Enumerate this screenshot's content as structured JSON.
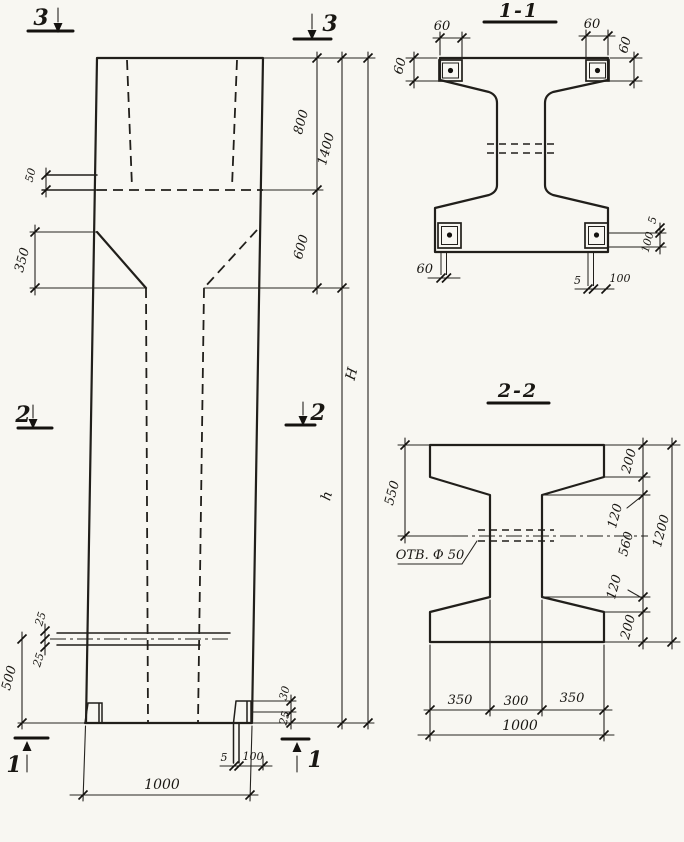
{
  "page": {
    "paper_color": "#f8f7f2",
    "ink_color": "#211f1b",
    "drawing_type": "reinforced concrete column working drawing"
  },
  "elevation": {
    "markers": {
      "top_left": "3",
      "top_right": "3",
      "mid_left": "2",
      "mid_right": "2",
      "bottom_left": "1",
      "bottom_right": "1"
    },
    "dims": {
      "ledge_height": "50",
      "taper_height": "350",
      "cap_upper": "800",
      "cap_total": "1400",
      "cap_lower": "600",
      "total_height": "H",
      "shaft_height": "h",
      "hole_above_center": "25",
      "hole_below_center": "25",
      "hole_to_base": "500",
      "foot_upper": "30",
      "foot_lower": "25",
      "plate_thickness": "5",
      "plate_length": "100",
      "base_width": "1000"
    }
  },
  "section11": {
    "title": "1-1",
    "dims": {
      "plate_tl_width": "60",
      "plate_tl_height": "60",
      "plate_tr_width": "60",
      "plate_tr_height": "60",
      "plate_bl_width": "60",
      "plate_br_thickness": "5",
      "plate_br_length": "100",
      "plate_right_thickness": "5",
      "plate_right_length": "100"
    }
  },
  "section22": {
    "title": "2-2",
    "hole_note": "ОТВ. Ф 50",
    "dims": {
      "top_to_hole": "550",
      "flange_top": "200",
      "haunch_top": "120",
      "web_height": "560",
      "haunch_bottom": "120",
      "flange_bottom": "200",
      "total_height": "1200",
      "bottom_left": "350",
      "bottom_middle": "300",
      "bottom_right": "350",
      "bottom_total": "1000"
    }
  }
}
